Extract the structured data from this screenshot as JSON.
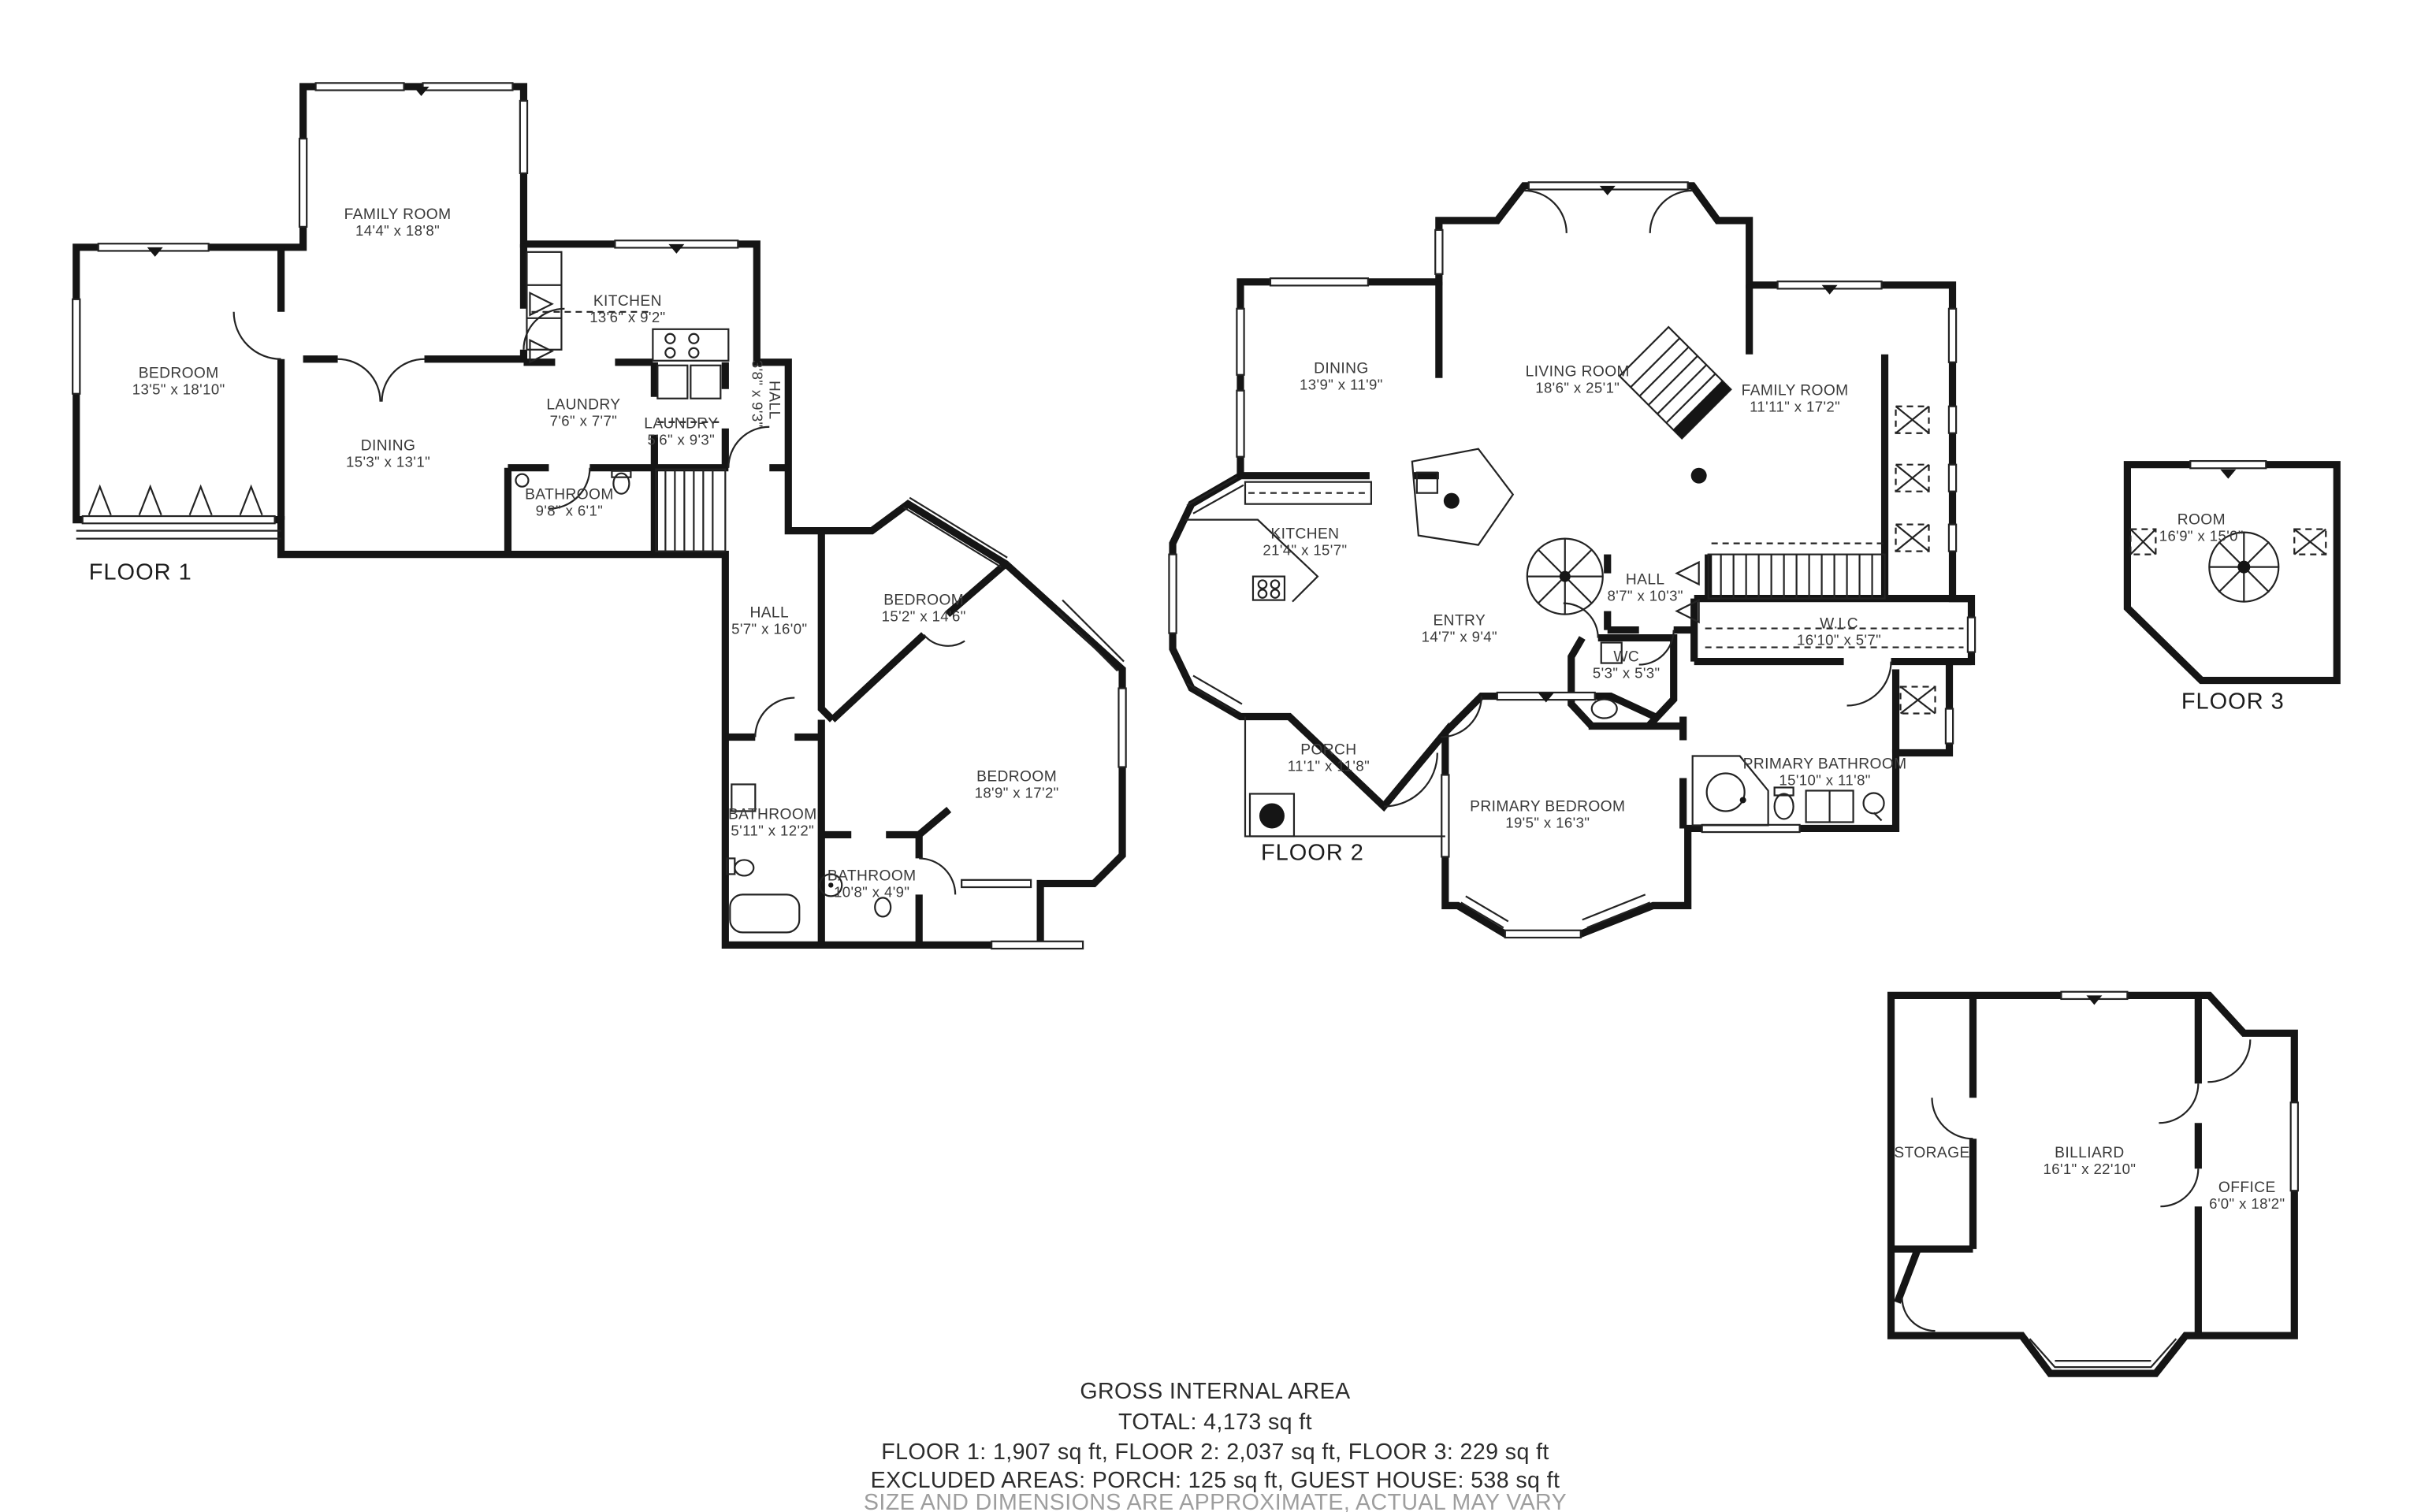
{
  "document": {
    "type": "residential-floor-plan",
    "style": "black-and-white 2D plan"
  },
  "colors": {
    "background": "#ffffff",
    "walls": "#151515",
    "room_text": "#3a3a3a",
    "floor_label_text": "#1c1c1c",
    "summary_text": "#2d2d2d",
    "disclaimer_text": "#9e9e9e"
  },
  "floors": {
    "floor1": {
      "label": "FLOOR 1",
      "rooms": {
        "family_room": {
          "name": "FAMILY ROOM",
          "dims": "14'4\" x 18'8\""
        },
        "bedroom_a": {
          "name": "BEDROOM",
          "dims": "13'5\" x 18'10\""
        },
        "dining": {
          "name": "DINING",
          "dims": "15'3\" x 13'1\""
        },
        "kitchen": {
          "name": "KITCHEN",
          "dims": "13'6\" x 9'2\""
        },
        "laundry_a": {
          "name": "LAUNDRY",
          "dims": "7'6\" x 7'7\""
        },
        "laundry_b": {
          "name": "LAUNDRY",
          "dims": "5'6\" x 9'3\""
        },
        "hall_a": {
          "name": "HALL",
          "dims": "3'8\" x 9'3\""
        },
        "bathroom_a": {
          "name": "BATHROOM",
          "dims": "9'8\" x 6'1\""
        },
        "hall_b": {
          "name": "HALL",
          "dims": "5'7\" x 16'0\""
        },
        "bedroom_b": {
          "name": "BEDROOM",
          "dims": "15'2\" x 14'6\""
        },
        "bedroom_c": {
          "name": "BEDROOM",
          "dims": "18'9\" x 17'2\""
        },
        "bathroom_b": {
          "name": "BATHROOM",
          "dims": "5'11\" x 12'2\""
        },
        "bathroom_c": {
          "name": "BATHROOM",
          "dims": "10'8\" x 4'9\""
        }
      }
    },
    "floor2": {
      "label": "FLOOR 2",
      "rooms": {
        "dining": {
          "name": "DINING",
          "dims": "13'9\" x 11'9\""
        },
        "living_room": {
          "name": "LIVING ROOM",
          "dims": "18'6\" x 25'1\""
        },
        "family_room": {
          "name": "FAMILY ROOM",
          "dims": "11'11\" x 17'2\""
        },
        "kitchen": {
          "name": "KITCHEN",
          "dims": "21'4\" x 15'7\""
        },
        "hall": {
          "name": "HALL",
          "dims": "8'7\" x 10'3\""
        },
        "wic": {
          "name": "W.I.C",
          "dims": "16'10\" x 5'7\""
        },
        "entry": {
          "name": "ENTRY",
          "dims": "14'7\" x 9'4\""
        },
        "wc": {
          "name": "WC",
          "dims": "5'3\" x 5'3\""
        },
        "porch": {
          "name": "PORCH",
          "dims": "11'1\" x 11'8\""
        },
        "primary_bedroom": {
          "name": "PRIMARY BEDROOM",
          "dims": "19'5\" x 16'3\""
        },
        "primary_bathroom": {
          "name": "PRIMARY BATHROOM",
          "dims": "15'10\" x 11'8\""
        }
      }
    },
    "floor3": {
      "label": "FLOOR 3",
      "rooms": {
        "room": {
          "name": "ROOM",
          "dims": "16'9\" x 15'0\""
        }
      }
    }
  },
  "guest_house": {
    "rooms": {
      "storage": {
        "name": "STORAGE",
        "dims": ""
      },
      "billiard": {
        "name": "BILLIARD",
        "dims": "16'1\" x 22'10\""
      },
      "office": {
        "name": "OFFICE",
        "dims": "6'0\" x 18'2\""
      }
    }
  },
  "summary": {
    "title": "GROSS INTERNAL AREA",
    "total": "TOTAL: 4,173 sq ft",
    "floors_line": "FLOOR 1: 1,907 sq ft, FLOOR 2: 2,037 sq ft, FLOOR 3: 229 sq ft",
    "excluded_line": "EXCLUDED AREAS: PORCH: 125 sq ft, GUEST HOUSE: 538 sq ft",
    "disclaimer": "SIZE AND DIMENSIONS ARE APPROXIMATE, ACTUAL MAY VARY"
  }
}
